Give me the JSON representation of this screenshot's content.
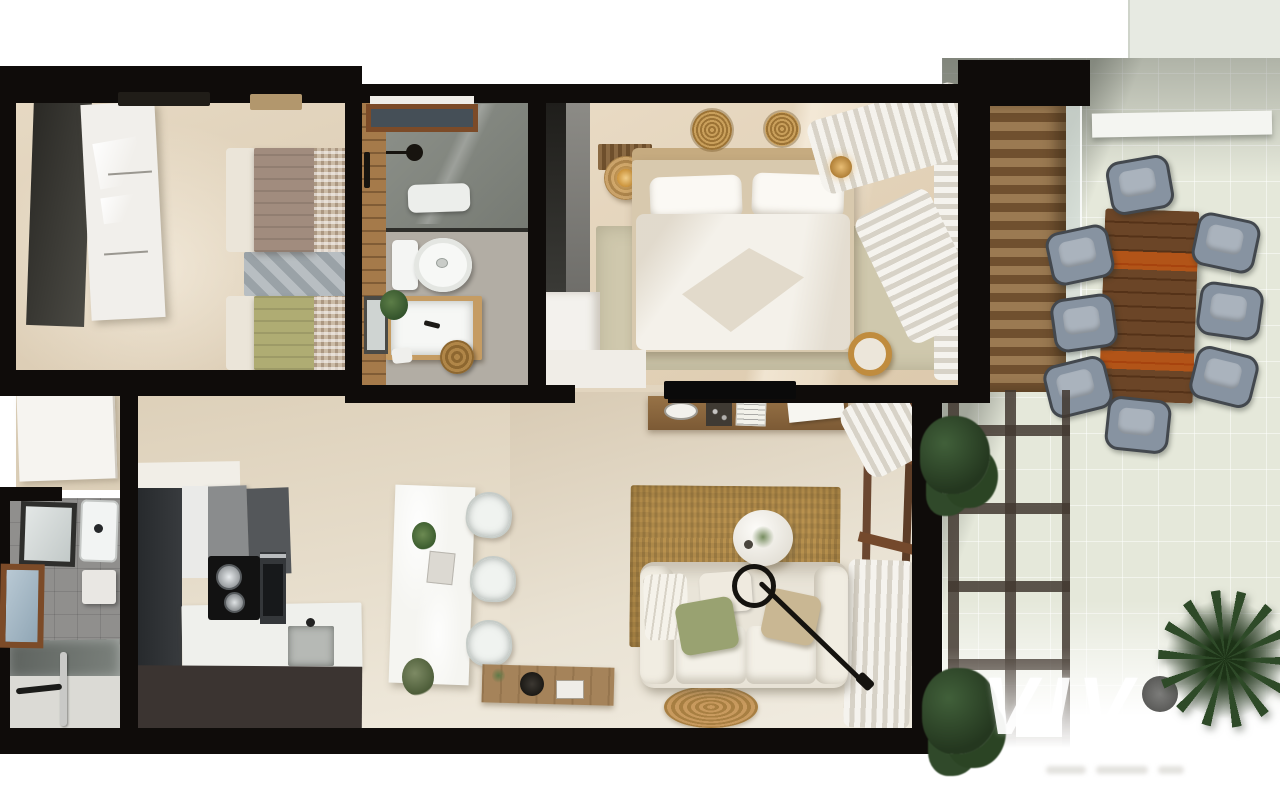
{
  "meta": {
    "type": "3d-floor-plan-render",
    "view": "top-down",
    "scene": "two-bedroom apartment with terrace"
  },
  "watermark": {
    "text": "VIV"
  },
  "colors": {
    "wall": "#0f0c0a",
    "floor": "#e3d5bf",
    "floor-light": "#efe9dc",
    "floor-master": "#e8dac4",
    "rug-sage": "#cfc8ad",
    "wood-wall": "#a57a4a",
    "tile-gray": "#b2ada4",
    "bath2-gray": "#908f8d",
    "kitchen-dark": "#2e3134",
    "kitchen-front": "#3b3431",
    "counter-white": "#eff0ec",
    "sofa-cream": "#e9e4d8",
    "jute": "#b8914e",
    "jute-dark": "#a07c3e",
    "terrace-floor": "#e5e8da",
    "slat-light": "#9b7a52",
    "slat-dark": "#70502f",
    "pergola": "#4a4038",
    "table-dark": "#6b4527",
    "table-light": "#bd8a4d",
    "chair-cushion": "#8793a1",
    "chair-frame": "#43484e",
    "plant": "#2e4a28",
    "curtain": "#f5f3ee",
    "curtain-shade": "#d7d2c7",
    "bed-white": "#f4f1ea",
    "headboard": "#c6ab80",
    "gold": "#c9a15a",
    "window-frame": "#7c4b28",
    "glass-blue": "#a3b8c6",
    "door-white": "#f6f4f0",
    "quilt-taupe": "#a18c7e",
    "quilt-green": "#afac73",
    "gingham-base": "#cbbba6",
    "rug-gray": "#9aa2a7",
    "watermark-white": "rgba(255,255,255,0.92)"
  },
  "rooms": [
    {
      "id": "bedroom-2",
      "furniture": [
        "white-wardrobe",
        "single-bed-taupe",
        "single-bed-green",
        "gray-rug",
        "wall-vent",
        "wall-shelf"
      ]
    },
    {
      "id": "bathroom-1",
      "furniture": [
        "walk-in-shower",
        "shower-window",
        "toilet",
        "vanity-sink",
        "mirror",
        "plant",
        "jute-basket",
        "towel-rail"
      ]
    },
    {
      "id": "master-bedroom",
      "furniture": [
        "double-bed",
        "sage-rug",
        "dark-wardrobe",
        "white-dresser",
        "slatted-bench",
        "side-table-lamp",
        "wall-medallions",
        "curtains",
        "pendant-lamp",
        "pouf"
      ]
    },
    {
      "id": "hallway",
      "furniture": [
        "entrance-door"
      ]
    },
    {
      "id": "bathroom-2",
      "furniture": [
        "mirror",
        "sink",
        "wall-cabinet",
        "window",
        "glass-shower"
      ]
    },
    {
      "id": "kitchen",
      "furniture": [
        "tall-cabinet",
        "wall-cabinets",
        "cooktop",
        "oven",
        "counter-sink",
        "dining-table",
        "dining-chairs",
        "floor-plant"
      ]
    },
    {
      "id": "living-room",
      "furniture": [
        "sofa",
        "coffee-table",
        "arc-floor-lamp",
        "jute-rug",
        "round-jute-rug",
        "tv-console",
        "wall-desk",
        "tv",
        "curtains",
        "sliding-door-frame"
      ]
    },
    {
      "id": "terrace",
      "furniture": [
        "wood-slat-wall",
        "glass-balustrade",
        "outdoor-dining-table",
        "outdoor-chairs",
        "pergola-grid",
        "shrubs",
        "palm-plant",
        "planter-pot",
        "parapet-ledge"
      ]
    }
  ]
}
